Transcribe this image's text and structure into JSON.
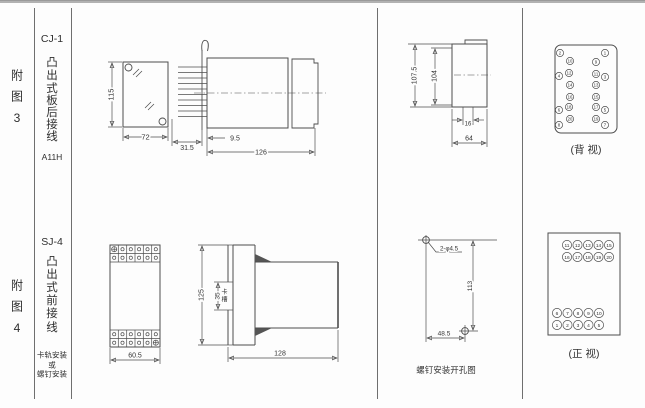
{
  "row1": {
    "fig": [
      "附",
      "图",
      "3"
    ],
    "model": "CJ-1",
    "type": [
      "凸",
      "出",
      "式",
      "板",
      "后",
      "接",
      "线"
    ],
    "code": "A11H",
    "front": {
      "h": "115",
      "w": "72"
    },
    "side": {
      "pin": "31.5",
      "offset": "9.5",
      "len": "126"
    },
    "panel": {
      "total": "107.5",
      "inner": "104",
      "gap": "16",
      "width": "64"
    },
    "term": {
      "caption": "(背 视)",
      "outer_left": [
        "2",
        "4",
        "6",
        "8"
      ],
      "inner_left": [
        "10",
        "12",
        "14",
        "16",
        "18",
        "20"
      ],
      "inner_right": [
        "9",
        "11",
        "13",
        "15",
        "17",
        "19"
      ],
      "outer_right": [
        "1",
        "3",
        "5",
        "7"
      ]
    }
  },
  "row2": {
    "fig": [
      "附",
      "图",
      "4"
    ],
    "model": "SJ-4",
    "type": [
      "凸",
      "出",
      "式",
      "前",
      "接",
      "线"
    ],
    "mount": [
      "卡轨安装",
      "或",
      "螺钉安装"
    ],
    "front": {
      "w": "60.5"
    },
    "side": {
      "h": "125",
      "slot": "35",
      "slot_label": [
        "卡",
        "槽"
      ],
      "depth": "128"
    },
    "drill": {
      "holes": "2-φ4.5",
      "v": "113",
      "h": "48.5",
      "caption": "螺钉安装开孔图"
    },
    "term": {
      "caption": "(正 视)",
      "r0": [
        "11",
        "12",
        "13",
        "14",
        "15"
      ],
      "r1": [
        "16",
        "17",
        "18",
        "19",
        "20"
      ],
      "r2": [
        "6",
        "7",
        "8",
        "9",
        "10"
      ],
      "r3": [
        "1",
        "2",
        "3",
        "4",
        "5"
      ]
    }
  }
}
